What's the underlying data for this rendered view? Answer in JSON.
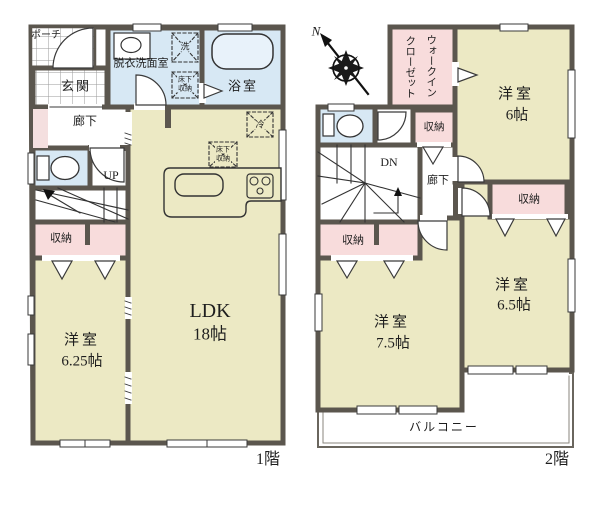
{
  "colors": {
    "wall": "#5b564e",
    "room_cream": "#ece9c4",
    "storage_pink": "#f8dcdc",
    "wet_area_blue": "#d7e8f4",
    "strip_pink": "#f4dfdf"
  },
  "compass": {
    "north_label": "N"
  },
  "floor1": {
    "floor_label": "1階",
    "rooms": {
      "porch": {
        "name": "ポーチ"
      },
      "entrance": {
        "name": "玄関"
      },
      "washroom": {
        "name": "脱衣洗面室"
      },
      "bathroom": {
        "name": "浴室"
      },
      "hallway": {
        "name": "廊下"
      },
      "stairs": {
        "direction_label": "UP"
      },
      "storage": {
        "name": "収納"
      },
      "bedroom": {
        "name": "洋室",
        "size": "6.25帖"
      },
      "ldk": {
        "name": "LDK",
        "size": "18帖"
      }
    },
    "annotations": {
      "washer": "洗",
      "fridge": "冷",
      "underfloor_storage_line1": "床下",
      "underfloor_storage_line2": "収納"
    }
  },
  "floor2": {
    "floor_label": "2階",
    "rooms": {
      "walk_in_closet": {
        "name_line1": "ウォークイン",
        "name_line2": "クローゼット"
      },
      "bedroom6": {
        "name": "洋室",
        "size": "6帖"
      },
      "bedroom65": {
        "name": "洋室",
        "size": "6.5帖"
      },
      "bedroom75": {
        "name": "洋室",
        "size": "7.5帖"
      },
      "hallway": {
        "name": "廊下"
      },
      "stairs": {
        "direction_label": "DN"
      },
      "storage_hall": {
        "name": "収納"
      },
      "storage_under_stairs": {
        "name": "収納"
      },
      "storage_bedroom65": {
        "name": "収納"
      },
      "balcony": {
        "name": "バルコニー"
      }
    }
  }
}
